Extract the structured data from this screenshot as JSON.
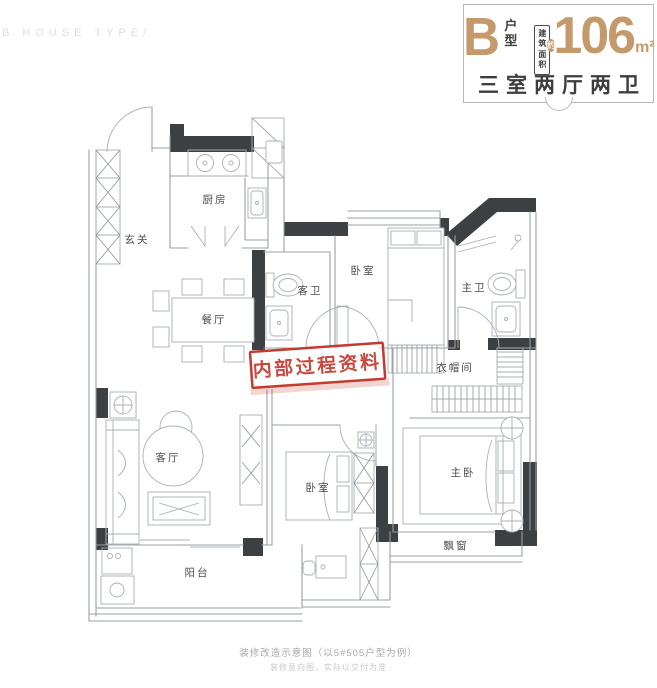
{
  "watermark": "B HOUSE TYPE/",
  "title_block": {
    "type_letter": "B",
    "type_label_1": "户",
    "type_label_2": "型",
    "area_label_1": "建筑",
    "area_label_2": "面积",
    "area_approx": "约",
    "area_value": "106",
    "area_unit": "m²",
    "subtitle": "三室两厅两卫"
  },
  "rooms": {
    "entry": "玄关",
    "kitchen": "厨房",
    "dining": "餐厅",
    "guest_bath": "客卫",
    "bedroom2": "卧室",
    "master_bath": "主卫",
    "cloakroom": "衣帽间",
    "living": "客厅",
    "bedroom3": "卧室",
    "master_bedroom": "主卧",
    "bay_window": "飘窗",
    "balcony": "阳台"
  },
  "stamp": {
    "text": "内部过程资料"
  },
  "captions": {
    "line1": "装修改造示意图（以5#505户型为例）",
    "line2": "装修意向图，实际以交付为准"
  },
  "colors": {
    "accent": "#C49A6C",
    "stamp_red": "#C23B2E",
    "wall_dark": "#3C4043",
    "line_gray": "#9AA0A6"
  }
}
